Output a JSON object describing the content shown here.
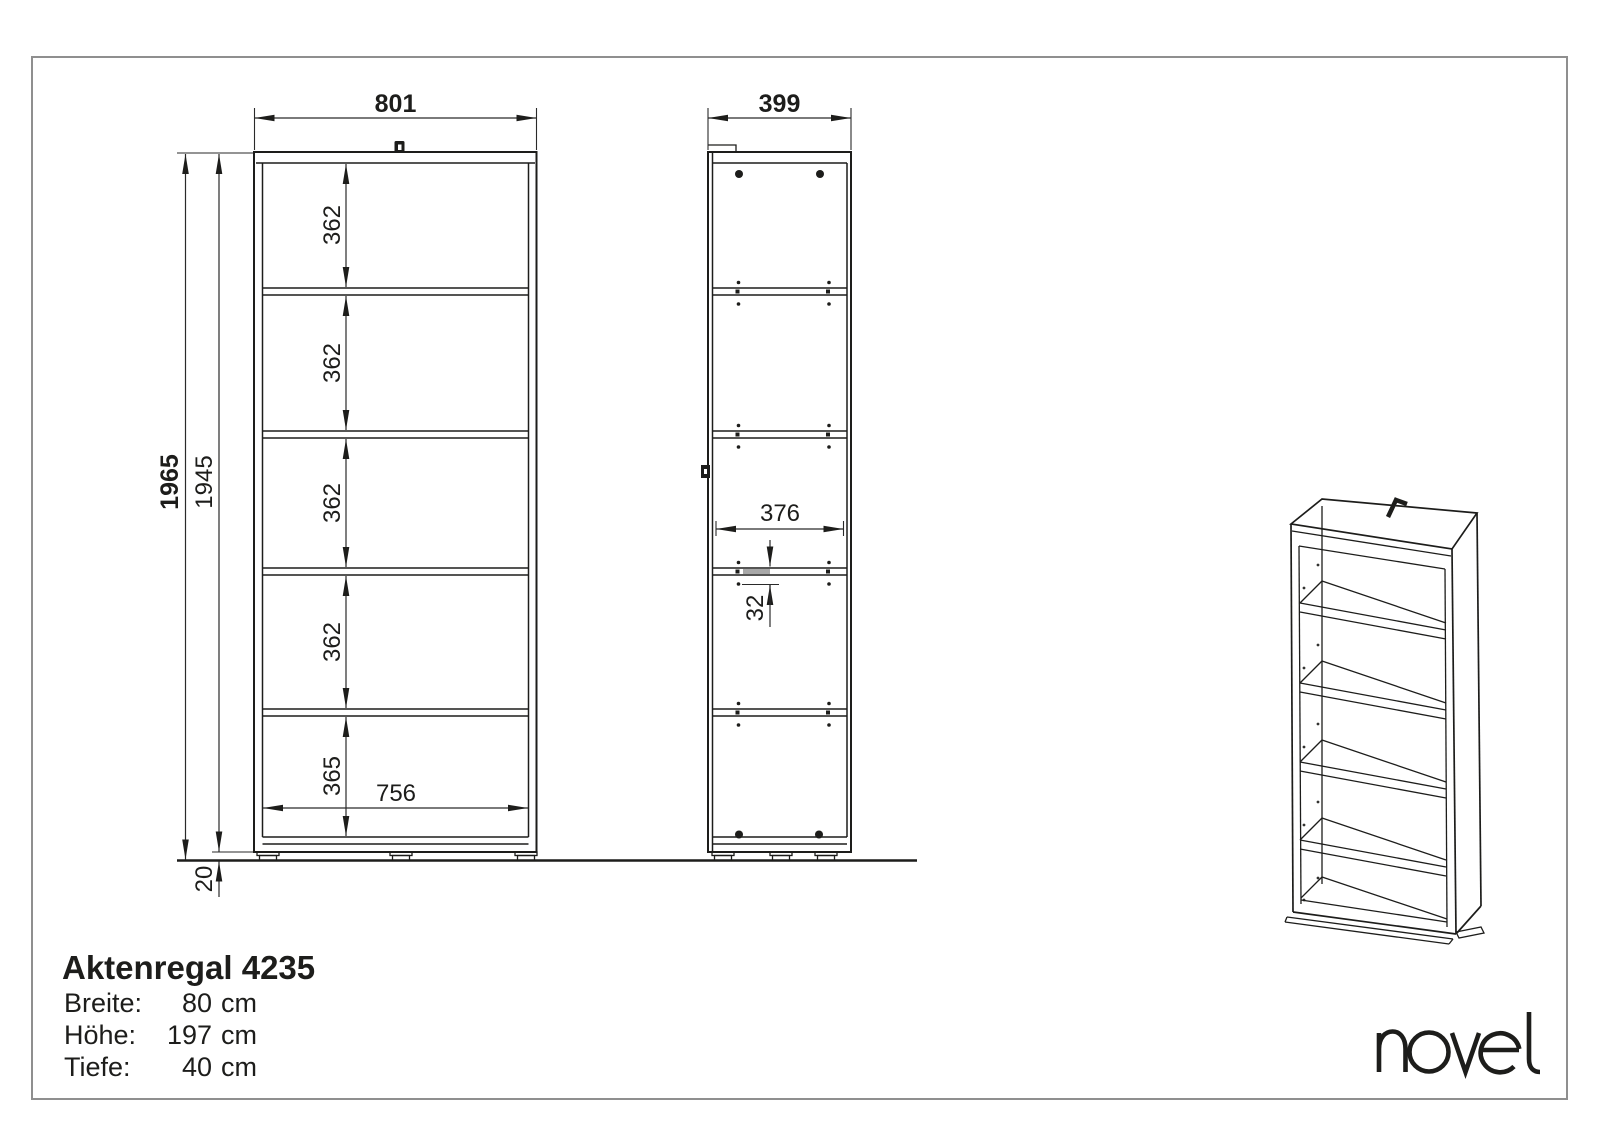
{
  "title_block": {
    "product_name": "Aktenregal 4235",
    "specs": [
      {
        "label": "Breite:",
        "value": "80",
        "unit": "cm"
      },
      {
        "label": "Höhe:",
        "value": "197",
        "unit": "cm"
      },
      {
        "label": "Tiefe:",
        "value": "40",
        "unit": "cm"
      }
    ]
  },
  "brand": {
    "logo_text": "novel"
  },
  "dimensions": {
    "front_view": {
      "width": "801",
      "height_total": "1965",
      "height_carcass": "1945",
      "shelf_pitches": [
        "362",
        "362",
        "362",
        "362"
      ],
      "bottom_shelf_pitch": "365",
      "inner_width": "756",
      "base_height": "20"
    },
    "side_view": {
      "depth": "399",
      "inner_depth": "376",
      "hole_pitch": "32"
    }
  },
  "colors": {
    "line": "#1d1d1b",
    "page_border": "#8f8f8f",
    "shelf_highlight": "#a8a8a8",
    "background": "#ffffff"
  }
}
